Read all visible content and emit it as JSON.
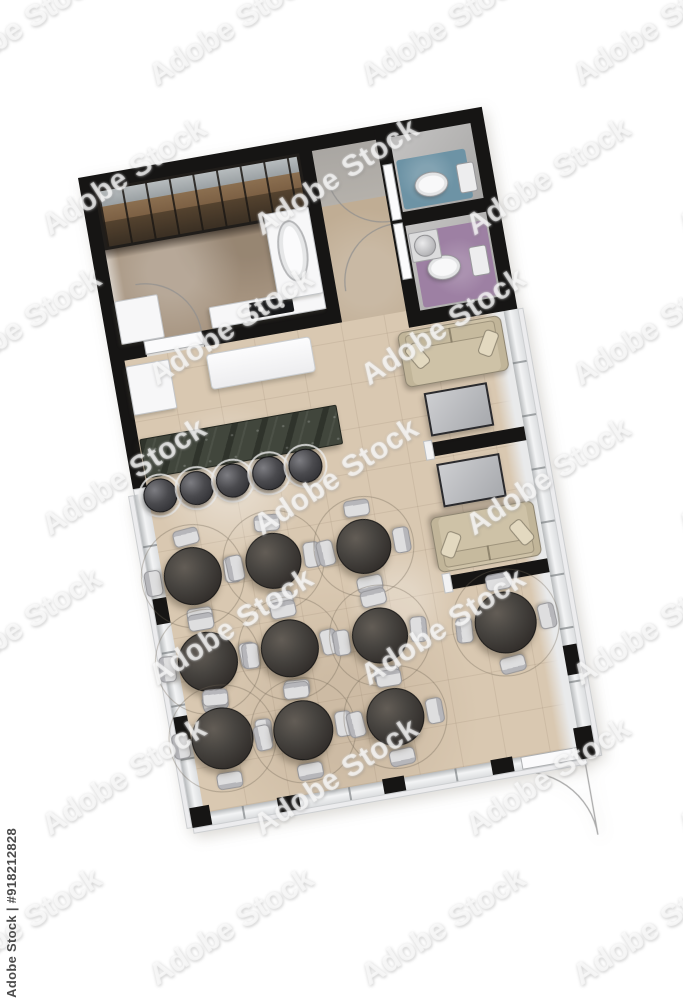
{
  "image": {
    "type": "3d-rendered floor plan, top view",
    "subject": "cafe-restaurant floor plan with kitchen, two bathrooms, bar and dining area"
  },
  "watermark": {
    "tile_text": "Adobe Stock",
    "id_text": "Adobe Stock | #918212828",
    "grid": {
      "row_y_start": 10,
      "row_step": 150,
      "col_step": 212,
      "row_offset": 105,
      "col_x_even": -75,
      "col_x_odd": 30,
      "rows": 7,
      "cols": 5
    }
  },
  "colors": {
    "wall": "#161514",
    "floor-main": "#d9c8b1",
    "floor-kitchen": "#a79581",
    "floor-corridor": "#c0ad94",
    "bath-blue": "#6d93a5",
    "bath-purple": "#9d80a3",
    "sofa": "#cec2a7",
    "bar": "#41463c"
  },
  "floor_plan": {
    "rotation_deg": -10,
    "rooms": [
      {
        "id": "kitchen",
        "label": "kitchen with shelving, cooktop counter and oval sink"
      },
      {
        "id": "corridor",
        "label": "corridor to bathrooms"
      },
      {
        "id": "bathroom-top",
        "label": "bathroom with teal floor and toilet"
      },
      {
        "id": "bathroom-bottom",
        "label": "bathroom with purple floor, toilet and round sink"
      },
      {
        "id": "lounge",
        "label": "window lounge with two beige sofas and two booth tables"
      },
      {
        "id": "dining-area",
        "label": "dining area with round tables and chairs"
      },
      {
        "id": "bar",
        "label": "dark stone bar counter with five stools"
      }
    ],
    "counts": {
      "dining_tables": 10,
      "chairs_per_table": 4,
      "bar_stools": 5,
      "sofas": 2,
      "booth_tables": 2,
      "toilets": 2,
      "sinks": 2,
      "door_arcs": 4
    },
    "dining_tables": [
      {
        "x": 44,
        "y": 412,
        "d": 58
      },
      {
        "x": 126,
        "y": 411,
        "d": 56
      },
      {
        "x": 217,
        "y": 412,
        "d": 55
      },
      {
        "x": 44,
        "y": 499,
        "d": 60
      },
      {
        "x": 127,
        "y": 500,
        "d": 58
      },
      {
        "x": 218,
        "y": 503,
        "d": 56
      },
      {
        "x": 45,
        "y": 577,
        "d": 62
      },
      {
        "x": 126,
        "y": 583,
        "d": 60
      },
      {
        "x": 219,
        "y": 586,
        "d": 58
      },
      {
        "x": 344,
        "y": 512,
        "d": 62
      }
    ],
    "bar_stools": [
      {
        "x": 26,
        "y": 327
      },
      {
        "x": 63,
        "y": 326
      },
      {
        "x": 100,
        "y": 325
      },
      {
        "x": 137,
        "y": 324
      },
      {
        "x": 174,
        "y": 323
      }
    ],
    "stool_d": 34
  }
}
